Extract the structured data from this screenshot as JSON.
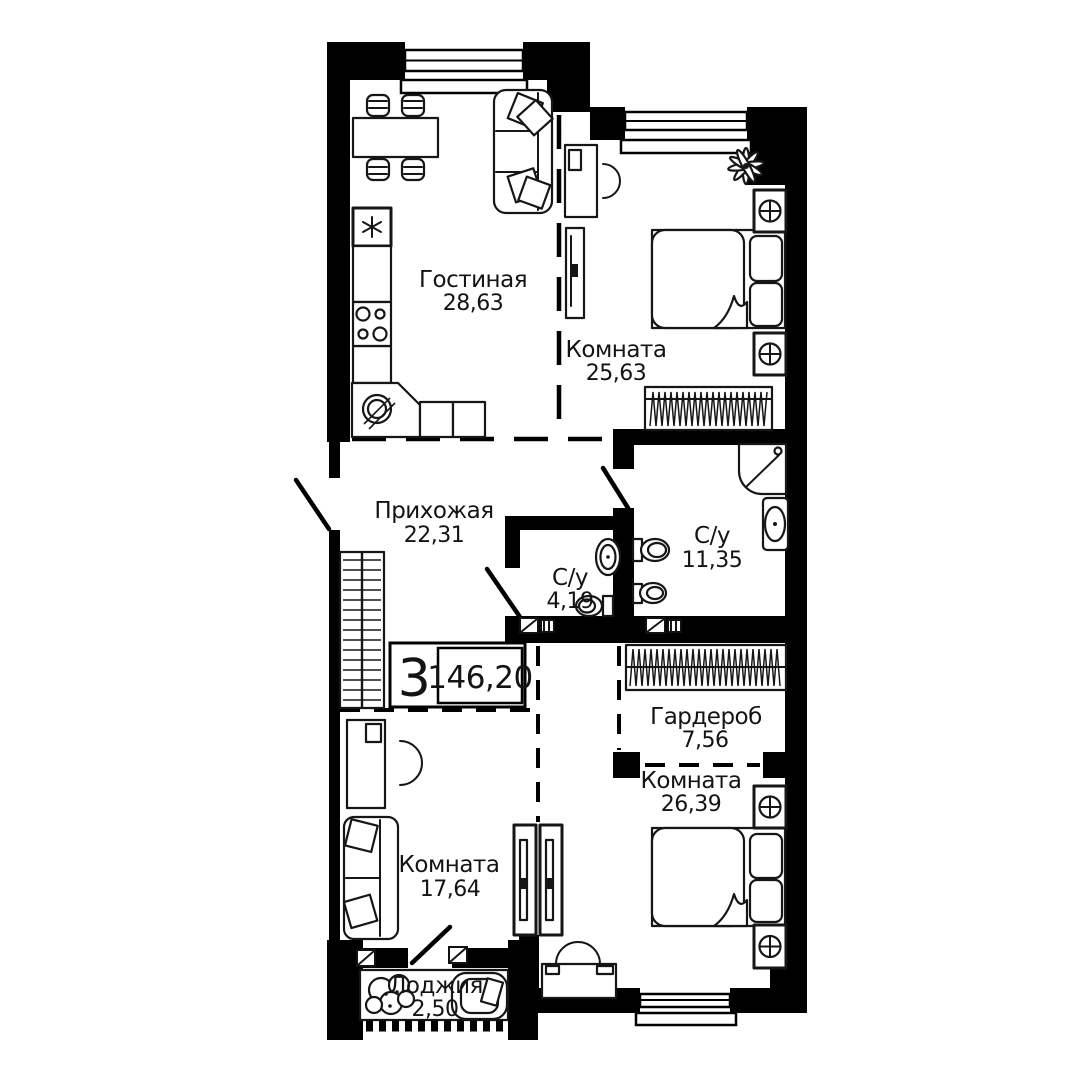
{
  "floorplan": {
    "badge": {
      "room_count": "3",
      "total_area": "146,20"
    },
    "rooms": [
      {
        "key": "living",
        "name": "Гостиная",
        "area": "28,63"
      },
      {
        "key": "bedroom_top",
        "name": "Комната",
        "area": "25,63"
      },
      {
        "key": "hallway",
        "name": "Прихожая",
        "area": "22,31"
      },
      {
        "key": "bathroom_small",
        "name": "С/у",
        "area": "4,19"
      },
      {
        "key": "bathroom_large",
        "name": "С/у",
        "area": "11,35"
      },
      {
        "key": "garderob",
        "name": "Гардероб",
        "area": "7,56"
      },
      {
        "key": "bedroom_bottom",
        "name": "Комната",
        "area": "26,39"
      },
      {
        "key": "room_left",
        "name": "Комната",
        "area": "17,64"
      },
      {
        "key": "loggia",
        "name": "Лоджия",
        "area": "2,50"
      }
    ],
    "icons": {
      "dining-table": "rect",
      "chair": "rounded-rect",
      "sofa": "rounded-rect+pillows",
      "fridge": "box+asterisk",
      "cooktop": "4-circles",
      "kitchen-sink": "circle+hatch",
      "desk": "rect",
      "desk-chair": "horseshoe-arc",
      "shelf": "tall-rect",
      "plant": "petal-burst",
      "double-bed": "rect+pillows+duvet",
      "vent-unit": "box+circled-plus",
      "radiator": "zigzag-box",
      "wardrobe-rail": "hatched-box",
      "shower": "quarter-round+diagonal",
      "washbasin": "oval",
      "toilet": "tank+oval",
      "bidet": "tank+oval",
      "sliding-door": "twin-panels",
      "armchair": "rounded-square",
      "door-swing": "diagonal-line",
      "window": "double-line",
      "railing": "dashed-strip"
    },
    "colors": {
      "wall": "#000000",
      "background": "#ffffff",
      "line": "#161616"
    }
  }
}
